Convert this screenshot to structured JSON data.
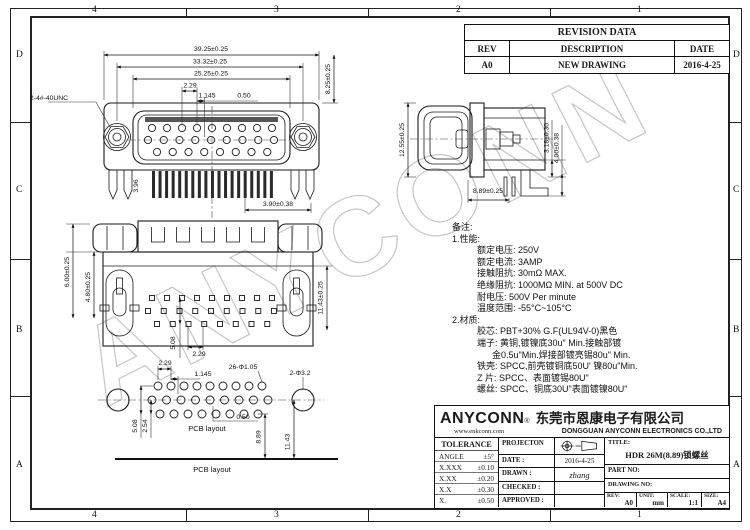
{
  "colors": {
    "line": "#1a1a1a",
    "watermark": "#c6c6c6",
    "background": "#ffffff"
  },
  "watermark": "ANYCONN",
  "frame": {
    "top_labels": [
      "4",
      "3",
      "2",
      "1"
    ],
    "bottom_labels": [
      "4",
      "3",
      "2",
      "1"
    ],
    "left_labels": [
      "D",
      "C",
      "B",
      "A"
    ],
    "right_labels": [
      "D",
      "C",
      "B",
      "A"
    ]
  },
  "revision": {
    "title": "REVISION DATA",
    "headers": [
      "REV",
      "DESCRIPTION",
      "DATE"
    ],
    "row": [
      "A0",
      "NEW DRAWING",
      "2016-4-25"
    ]
  },
  "dims": {
    "front": {
      "total_width": "39.25±0.25",
      "screw_span": "33.32±0.25",
      "shroud_width": "25.25±0.25",
      "pitch": "2.29",
      "half_pitch": "1.145",
      "row_offset": "0.50",
      "height": "8.25±0.25",
      "thread_callout": "2-4#-40UNC",
      "leg_height": "3.96",
      "pin_length": "3.90±0.38"
    },
    "side": {
      "height": "12.55±0.25",
      "tail_offset1": "3.18±0.30",
      "tail_offset2": "4.00±0.38",
      "depth": "8.89±0.25"
    },
    "rear": {
      "h_top": "6.00±0.25",
      "h_mid": "4.80±0.25",
      "h_total": "11.43±0.25",
      "row_span": "5.08",
      "pitch": "2.29"
    },
    "pcb": {
      "pitch": "2.29",
      "half_pitch": "1.145",
      "pin_holes": "26-Φ1.05",
      "mount_holes": "2-Φ3.2",
      "row_offset": "0.50",
      "row_span": "5.08",
      "row_gap": "2.54",
      "edge_dist": "8.89",
      "mount_edge_dist": "11.43",
      "label": "PCB layout",
      "footer_label": "PCB layout"
    }
  },
  "notes": {
    "title": "备注:",
    "sec1": "1.性能:",
    "perf": [
      "额定电压: 250V",
      "额定电流: 3AMP",
      "接触阻抗: 30mΩ MAX.",
      "绝缘阻抗: 1000MΩ MIN. at 500V DC",
      "耐电压: 500V Per minute",
      "温度范围: -55°C~105°C"
    ],
    "sec2": "2.材质:",
    "mat": [
      "胶芯: PBT+30% G.F(UL94V-0)黑色",
      "端子: 黄铜,镀镍底30u\" Min.接触部镀",
      "金0.5u\"Min.焊接部镀亮锡80u\" Min.",
      "铁壳: SPCC,前壳镀铜底50U' 镍80u\"Min.",
      "Z 片: SPCC、表面镀锡80U\"",
      "螺丝: SPCC、铜底30U\"表面镀镍80U\""
    ]
  },
  "company": {
    "logo": "ANYCONN",
    "reg": "®",
    "cn_name": "东莞市恩康电子有限公司",
    "website": "www.enkconn.com",
    "en_name": "DONGGUAN ANYCONN ELECTRONICS CO.,LTD"
  },
  "tolerance": {
    "header": "TOLERANCE",
    "rows": [
      [
        "ANGLE",
        "±5°"
      ],
      [
        "X.XXX",
        "±0.10"
      ],
      [
        "X.XX",
        "±0.20"
      ],
      [
        "X.X",
        "±0.30"
      ],
      [
        "X.",
        "±0.50"
      ]
    ]
  },
  "approval": {
    "projection_label": "PROJECTON",
    "date_label": "DATE :",
    "date_value": "2016-4-25",
    "drawn_label": "DRAWN :",
    "drawn_value": "zhang",
    "checked_label": "CHECKED :",
    "approved_label": "APPROVED :"
  },
  "titleblock": {
    "title_label": "TITLE:",
    "title_value": "HDR 26M(8.89)锁螺丝",
    "part_no_label": "PART NO:",
    "drawing_no_label": "DRAWING NO:",
    "rev_label": "REV:",
    "rev_value": "A0",
    "unit_label": "UNIT:",
    "unit_value": "mm",
    "scale_label": "SCALE:",
    "scale_value": "1:1",
    "size_label": "SIZE:",
    "size_value": "A4"
  }
}
